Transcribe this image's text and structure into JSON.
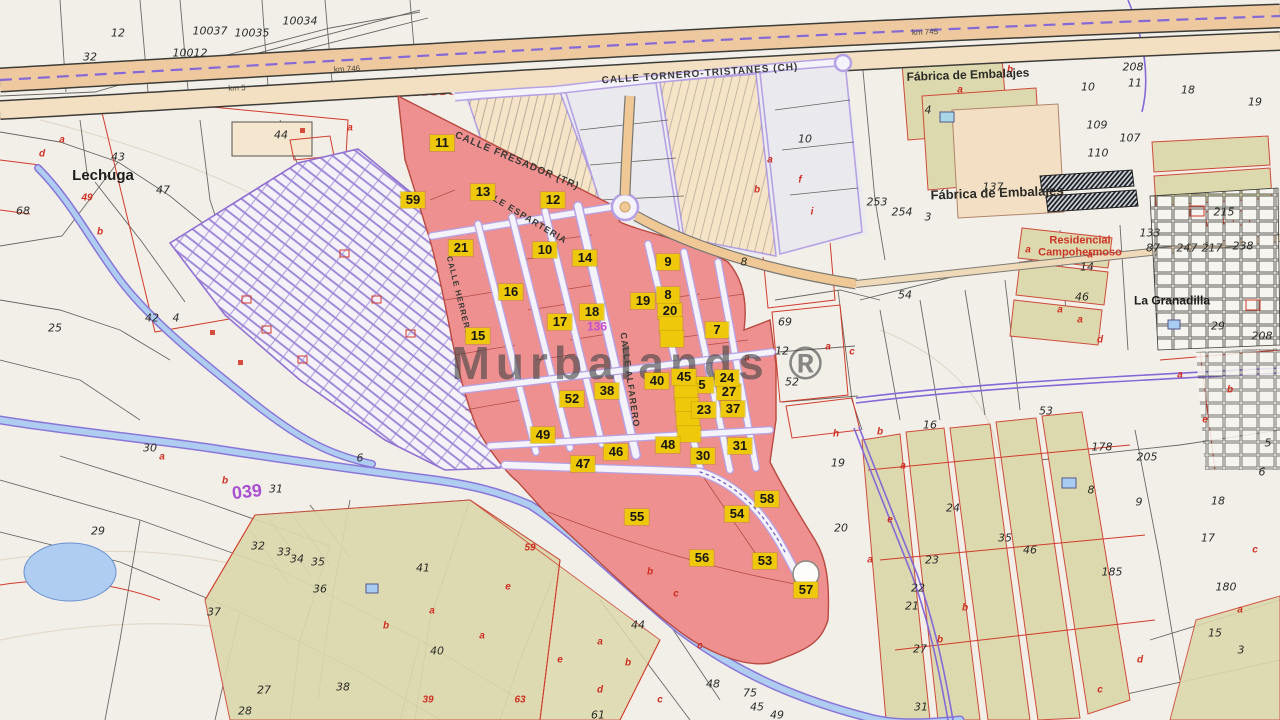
{
  "map": {
    "watermark": "Murbalands ®",
    "colors": {
      "highlight_pink": "#ee9090",
      "label_yellow": "#eec80a",
      "planning_lavender": "#a18bd8",
      "water_blue": "#a9cdf2",
      "road_tan": "#f0c896",
      "field_olive": "#dcd9ae",
      "cadastral_red": "#d03a2a"
    },
    "street_names": [
      {
        "text": "CALLE TORNERO-TRISTANES (CH)",
        "x": 700,
        "y": 74,
        "rotate": -4,
        "size": 10
      },
      {
        "text": "CALLE FRESADOR (TR)",
        "x": 517,
        "y": 161,
        "rotate": 23,
        "size": 10
      },
      {
        "text": "CALLE ESPARTERIA",
        "x": 521,
        "y": 214,
        "rotate": 31,
        "size": 9
      },
      {
        "text": "CALLE ALFARERO",
        "x": 630,
        "y": 380,
        "rotate": 82,
        "size": 9
      },
      {
        "text": "CALLE HERRERO",
        "x": 459,
        "y": 296,
        "rotate": 76,
        "size": 8
      }
    ],
    "road_markers": [
      {
        "text": "km 746",
        "x": 347,
        "y": 69,
        "rotate": -3,
        "size": 8
      },
      {
        "text": "km 745",
        "x": 925,
        "y": 32,
        "rotate": -2,
        "size": 8
      },
      {
        "text": "km 5",
        "x": 237,
        "y": 88,
        "rotate": -2,
        "size": 8
      }
    ],
    "place_labels": [
      {
        "text": "Lechuga",
        "x": 103,
        "y": 176,
        "size": 15,
        "color": "#1d1d1b"
      },
      {
        "text": "Fábrica de Embalajes",
        "x": 968,
        "y": 75,
        "size": 12,
        "color": "#2a2a26",
        "rotate": -2
      },
      {
        "text": "Fábrica de Embalajes",
        "x": 997,
        "y": 193,
        "size": 13,
        "color": "#2a2a26",
        "rotate": -2
      },
      {
        "text": "Residencial\nCampohermoso",
        "x": 1080,
        "y": 247,
        "size": 11,
        "color": "#cc3327"
      },
      {
        "text": "La Granadilla",
        "x": 1172,
        "y": 301,
        "size": 12,
        "color": "#1d1d1b"
      },
      {
        "text": "039",
        "x": 247,
        "y": 492,
        "size": 18,
        "color": "#a94fd0",
        "rotate": -6
      },
      {
        "text": "136",
        "x": 597,
        "y": 327,
        "size": 12,
        "color": "#c44fd0"
      }
    ],
    "parcel_labels": [
      {
        "t": "20",
        "x": 670,
        "y": 311
      },
      {
        "t": "",
        "x": 671,
        "y": 325
      },
      {
        "t": "",
        "x": 672,
        "y": 339
      },
      {
        "t": "27",
        "x": 729,
        "y": 392
      },
      {
        "t": "5",
        "x": 702,
        "y": 385
      },
      {
        "t": "",
        "x": 686,
        "y": 392
      },
      {
        "t": "",
        "x": 687,
        "y": 406
      },
      {
        "t": "",
        "x": 688,
        "y": 420
      },
      {
        "t": "",
        "x": 689,
        "y": 434
      },
      {
        "t": "30",
        "x": 703,
        "y": 456
      },
      {
        "t": "11",
        "x": 442,
        "y": 143
      },
      {
        "t": "59",
        "x": 413,
        "y": 200
      },
      {
        "t": "13",
        "x": 483,
        "y": 192
      },
      {
        "t": "12",
        "x": 553,
        "y": 200
      },
      {
        "t": "21",
        "x": 461,
        "y": 248
      },
      {
        "t": "10",
        "x": 545,
        "y": 250
      },
      {
        "t": "14",
        "x": 585,
        "y": 258
      },
      {
        "t": "9",
        "x": 668,
        "y": 262
      },
      {
        "t": "16",
        "x": 511,
        "y": 292
      },
      {
        "t": "19",
        "x": 643,
        "y": 301
      },
      {
        "t": "8",
        "x": 668,
        "y": 295
      },
      {
        "t": "7",
        "x": 717,
        "y": 330
      },
      {
        "t": "18",
        "x": 592,
        "y": 312
      },
      {
        "t": "17",
        "x": 560,
        "y": 322
      },
      {
        "t": "15",
        "x": 478,
        "y": 336
      },
      {
        "t": "38",
        "x": 607,
        "y": 391
      },
      {
        "t": "52",
        "x": 572,
        "y": 399
      },
      {
        "t": "40",
        "x": 657,
        "y": 381
      },
      {
        "t": "45",
        "x": 684,
        "y": 377
      },
      {
        "t": "24",
        "x": 727,
        "y": 378
      },
      {
        "t": "23",
        "x": 704,
        "y": 410
      },
      {
        "t": "37",
        "x": 733,
        "y": 409
      },
      {
        "t": "48",
        "x": 668,
        "y": 445
      },
      {
        "t": "31",
        "x": 740,
        "y": 446
      },
      {
        "t": "49",
        "x": 543,
        "y": 435
      },
      {
        "t": "46",
        "x": 616,
        "y": 452
      },
      {
        "t": "47",
        "x": 583,
        "y": 464
      },
      {
        "t": "55",
        "x": 637,
        "y": 517
      },
      {
        "t": "58",
        "x": 767,
        "y": 499
      },
      {
        "t": "54",
        "x": 737,
        "y": 514
      },
      {
        "t": "56",
        "x": 702,
        "y": 558
      },
      {
        "t": "53",
        "x": 765,
        "y": 561
      },
      {
        "t": "57",
        "x": 806,
        "y": 590
      }
    ],
    "parcel_numbers": [
      {
        "t": "10037",
        "x": 210,
        "y": 31
      },
      {
        "t": "10035",
        "x": 252,
        "y": 33
      },
      {
        "t": "10034",
        "x": 300,
        "y": 21
      },
      {
        "t": "10012",
        "x": 190,
        "y": 53
      },
      {
        "t": "12",
        "x": 118,
        "y": 33
      },
      {
        "t": "32",
        "x": 90,
        "y": 57
      },
      {
        "t": "44",
        "x": 281,
        "y": 135
      },
      {
        "t": "43",
        "x": 118,
        "y": 157
      },
      {
        "t": "47",
        "x": 163,
        "y": 190
      },
      {
        "t": "68",
        "x": 23,
        "y": 211
      },
      {
        "t": "42",
        "x": 152,
        "y": 318
      },
      {
        "t": "4",
        "x": 176,
        "y": 318
      },
      {
        "t": "25",
        "x": 55,
        "y": 328
      },
      {
        "t": "30",
        "x": 150,
        "y": 448
      },
      {
        "t": "31",
        "x": 276,
        "y": 489
      },
      {
        "t": "6",
        "x": 360,
        "y": 458
      },
      {
        "t": "29",
        "x": 98,
        "y": 531
      },
      {
        "t": "32",
        "x": 258,
        "y": 546
      },
      {
        "t": "33",
        "x": 284,
        "y": 552
      },
      {
        "t": "34",
        "x": 297,
        "y": 559
      },
      {
        "t": "35",
        "x": 318,
        "y": 562
      },
      {
        "t": "36",
        "x": 320,
        "y": 589
      },
      {
        "t": "37",
        "x": 214,
        "y": 612
      },
      {
        "t": "27",
        "x": 264,
        "y": 690
      },
      {
        "t": "28",
        "x": 245,
        "y": 711
      },
      {
        "t": "41",
        "x": 423,
        "y": 568
      },
      {
        "t": "40",
        "x": 437,
        "y": 651
      },
      {
        "t": "38",
        "x": 343,
        "y": 687
      },
      {
        "t": "44",
        "x": 638,
        "y": 625
      },
      {
        "t": "48",
        "x": 713,
        "y": 684
      },
      {
        "t": "75",
        "x": 750,
        "y": 693
      },
      {
        "t": "49",
        "x": 777,
        "y": 715
      },
      {
        "t": "61",
        "x": 598,
        "y": 715
      },
      {
        "t": "8",
        "x": 744,
        "y": 262
      },
      {
        "t": "19",
        "x": 838,
        "y": 463
      },
      {
        "t": "20",
        "x": 841,
        "y": 528
      },
      {
        "t": "69",
        "x": 785,
        "y": 322
      },
      {
        "t": "12",
        "x": 782,
        "y": 351
      },
      {
        "t": "52",
        "x": 792,
        "y": 382
      },
      {
        "t": "10",
        "x": 805,
        "y": 139
      },
      {
        "t": "205",
        "x": 1147,
        "y": 457
      },
      {
        "t": "9",
        "x": 1139,
        "y": 502
      },
      {
        "t": "8",
        "x": 1091,
        "y": 490
      },
      {
        "t": "178",
        "x": 1102,
        "y": 447
      },
      {
        "t": "185",
        "x": 1112,
        "y": 572
      },
      {
        "t": "35",
        "x": 1005,
        "y": 538
      },
      {
        "t": "46",
        "x": 1030,
        "y": 550
      },
      {
        "t": "22",
        "x": 918,
        "y": 588
      },
      {
        "t": "23",
        "x": 932,
        "y": 560
      },
      {
        "t": "21",
        "x": 912,
        "y": 606
      },
      {
        "t": "24",
        "x": 953,
        "y": 508
      },
      {
        "t": "16",
        "x": 930,
        "y": 425
      },
      {
        "t": "54",
        "x": 905,
        "y": 295
      },
      {
        "t": "53",
        "x": 1046,
        "y": 411
      },
      {
        "t": "18",
        "x": 1218,
        "y": 501
      },
      {
        "t": "17",
        "x": 1208,
        "y": 538
      },
      {
        "t": "180",
        "x": 1226,
        "y": 587
      },
      {
        "t": "5",
        "x": 1268,
        "y": 443
      },
      {
        "t": "6",
        "x": 1262,
        "y": 472
      },
      {
        "t": "208",
        "x": 1133,
        "y": 67
      },
      {
        "t": "11",
        "x": 1135,
        "y": 83
      },
      {
        "t": "18",
        "x": 1188,
        "y": 90
      },
      {
        "t": "19",
        "x": 1255,
        "y": 102
      },
      {
        "t": "10",
        "x": 1088,
        "y": 87
      },
      {
        "t": "109",
        "x": 1097,
        "y": 125
      },
      {
        "t": "110",
        "x": 1098,
        "y": 153
      },
      {
        "t": "253",
        "x": 877,
        "y": 202
      },
      {
        "t": "254",
        "x": 902,
        "y": 212
      },
      {
        "t": "3",
        "x": 928,
        "y": 217
      },
      {
        "t": "4",
        "x": 928,
        "y": 110
      },
      {
        "t": "137",
        "x": 993,
        "y": 187
      },
      {
        "t": "107",
        "x": 1130,
        "y": 138
      },
      {
        "t": "133",
        "x": 1150,
        "y": 233
      },
      {
        "t": "87",
        "x": 1153,
        "y": 248
      },
      {
        "t": "14",
        "x": 1087,
        "y": 267
      },
      {
        "t": "46",
        "x": 1082,
        "y": 297
      },
      {
        "t": "247",
        "x": 1187,
        "y": 248
      },
      {
        "t": "217",
        "x": 1212,
        "y": 248
      },
      {
        "t": "215",
        "x": 1224,
        "y": 212
      },
      {
        "t": "238",
        "x": 1243,
        "y": 246
      },
      {
        "t": "29",
        "x": 1218,
        "y": 326
      },
      {
        "t": "208",
        "x": 1262,
        "y": 336
      },
      {
        "t": "15",
        "x": 1215,
        "y": 633
      },
      {
        "t": "3",
        "x": 1241,
        "y": 650
      },
      {
        "t": "45",
        "x": 757,
        "y": 707
      },
      {
        "t": "27",
        "x": 920,
        "y": 649
      },
      {
        "t": "31",
        "x": 921,
        "y": 707
      }
    ],
    "red_marks": [
      {
        "t": "49",
        "x": 87,
        "y": 198
      },
      {
        "t": "59",
        "x": 530,
        "y": 548
      },
      {
        "t": "39",
        "x": 428,
        "y": 700
      },
      {
        "t": "63",
        "x": 520,
        "y": 700
      },
      {
        "t": "a",
        "x": 828,
        "y": 347
      },
      {
        "t": "c",
        "x": 852,
        "y": 352
      },
      {
        "t": "a",
        "x": 747,
        "y": 358
      },
      {
        "t": "h",
        "x": 836,
        "y": 434
      },
      {
        "t": "b",
        "x": 880,
        "y": 432
      },
      {
        "t": "a",
        "x": 903,
        "y": 466
      },
      {
        "t": "b",
        "x": 650,
        "y": 572
      },
      {
        "t": "c",
        "x": 676,
        "y": 594
      },
      {
        "t": "a",
        "x": 600,
        "y": 642
      },
      {
        "t": "b",
        "x": 628,
        "y": 663
      },
      {
        "t": "c",
        "x": 700,
        "y": 646
      },
      {
        "t": "a",
        "x": 482,
        "y": 636
      },
      {
        "t": "e",
        "x": 508,
        "y": 587
      },
      {
        "t": "a",
        "x": 432,
        "y": 611
      },
      {
        "t": "b",
        "x": 386,
        "y": 626
      },
      {
        "t": "a",
        "x": 62,
        "y": 140
      },
      {
        "t": "d",
        "x": 42,
        "y": 154
      },
      {
        "t": "b",
        "x": 100,
        "y": 232
      },
      {
        "t": "b",
        "x": 225,
        "y": 481
      },
      {
        "t": "a",
        "x": 162,
        "y": 457
      },
      {
        "t": "a",
        "x": 350,
        "y": 128
      },
      {
        "t": "b",
        "x": 757,
        "y": 190
      },
      {
        "t": "a",
        "x": 770,
        "y": 160
      },
      {
        "t": "i",
        "x": 812,
        "y": 212
      },
      {
        "t": "f",
        "x": 800,
        "y": 180
      },
      {
        "t": "a",
        "x": 960,
        "y": 90
      },
      {
        "t": "b",
        "x": 1010,
        "y": 70
      },
      {
        "t": "b",
        "x": 940,
        "y": 640
      },
      {
        "t": "b",
        "x": 965,
        "y": 608
      },
      {
        "t": "c",
        "x": 1100,
        "y": 690
      },
      {
        "t": "d",
        "x": 1140,
        "y": 660
      },
      {
        "t": "e",
        "x": 560,
        "y": 660
      },
      {
        "t": "d",
        "x": 600,
        "y": 690
      },
      {
        "t": "c",
        "x": 660,
        "y": 700
      },
      {
        "t": "a",
        "x": 1028,
        "y": 250
      },
      {
        "t": "a",
        "x": 1060,
        "y": 310
      },
      {
        "t": "a",
        "x": 1180,
        "y": 375
      },
      {
        "t": "b",
        "x": 1230,
        "y": 390
      },
      {
        "t": "e",
        "x": 1205,
        "y": 420
      },
      {
        "t": "a",
        "x": 870,
        "y": 560
      },
      {
        "t": "e",
        "x": 890,
        "y": 520
      },
      {
        "t": "c",
        "x": 1255,
        "y": 550
      },
      {
        "t": "a",
        "x": 1240,
        "y": 610
      },
      {
        "t": "a",
        "x": 1090,
        "y": 255
      },
      {
        "t": "a",
        "x": 1080,
        "y": 320
      },
      {
        "t": "d",
        "x": 1100,
        "y": 340
      }
    ]
  }
}
